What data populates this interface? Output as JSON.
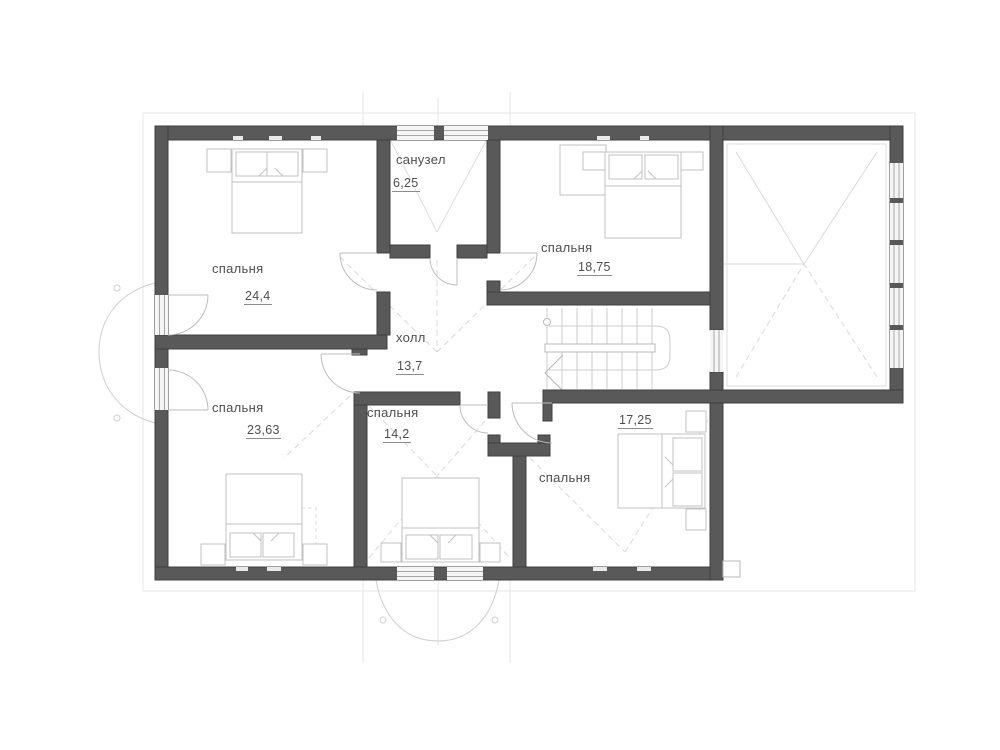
{
  "plan": {
    "type": "floor-plan",
    "rooms": [
      {
        "id": "bathroom",
        "label": "санузел",
        "area": "6,25"
      },
      {
        "id": "bedroom-top-left",
        "label": "спальня",
        "area": "24,4"
      },
      {
        "id": "bedroom-top-right",
        "label": "спальня",
        "area": "18,75"
      },
      {
        "id": "hall",
        "label": "холл",
        "area": "13,7"
      },
      {
        "id": "bedroom-bottom-left",
        "label": "спальня",
        "area": "23,63"
      },
      {
        "id": "bedroom-bottom-mid",
        "label": "спальня",
        "area": "14,2"
      },
      {
        "id": "bedroom-bottom-right",
        "label": "спальня",
        "area": "17,25"
      }
    ],
    "colors": {
      "wall": "#595959",
      "furniture_line": "#c2c2c2",
      "dash_line": "#d9d9d9",
      "window_frame": "#a6a6a6",
      "text": "#4e4e4e",
      "background": "#ffffff"
    }
  }
}
